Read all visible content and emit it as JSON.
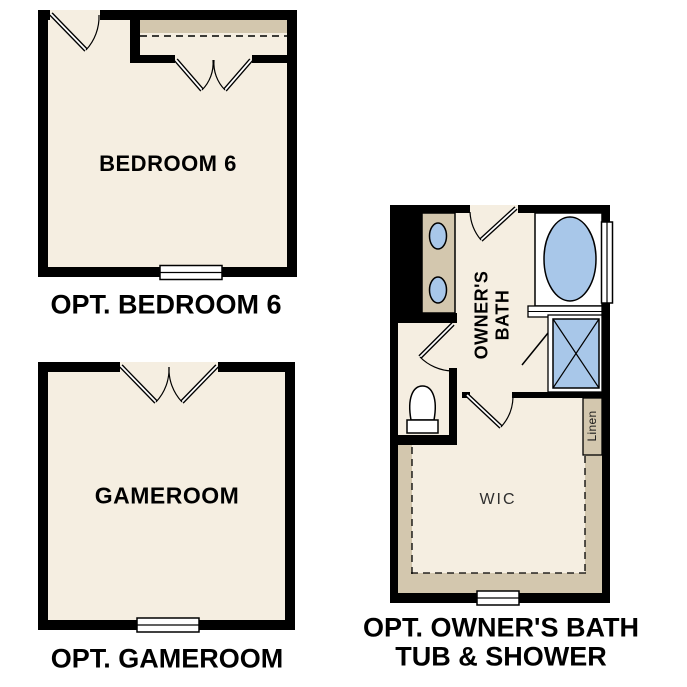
{
  "page": {
    "background": "#FFFFFF"
  },
  "colors": {
    "wall": "#000000",
    "floor": "#F5EEE1",
    "shelf_tan": "#D3C7AE",
    "fixture_blue": "#A8C7E9",
    "window_white": "#FFFFFF",
    "label_text": "#000000",
    "wic_text": "#2E2E2E"
  },
  "plans": {
    "bedroom6": {
      "room_label": "BEDROOM 6",
      "caption": "OPT. BEDROOM 6"
    },
    "gameroom": {
      "room_label": "GAMEROOM",
      "caption": "OPT. GAMEROOM"
    },
    "owners_bath": {
      "room_label_line1": "OWNER'S",
      "room_label_line2": "BATH",
      "wic_label": "WIC",
      "linen_label": "Linen",
      "caption_line1": "OPT. OWNER'S BATH",
      "caption_line2": "TUB & SHOWER"
    }
  }
}
